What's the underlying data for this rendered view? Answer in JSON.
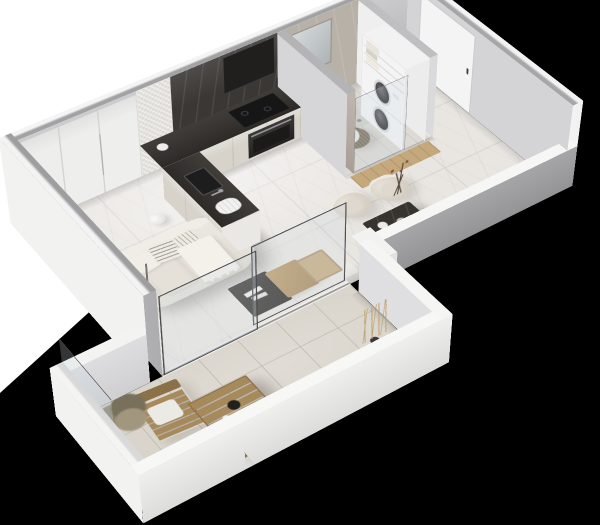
{
  "meta": {
    "description": "Photorealistic isometric 3D render of a small studio apartment floor plan, viewed from above at an angle, on a black void with a white backdrop filling the upper-left corner.",
    "width": 600,
    "height": 525
  },
  "palette": {
    "bg_black": "#000000",
    "backdrop_white": "#ffffff",
    "wall_far_face": "#c3c3c5",
    "wall_outer_white": "#f2f2f1",
    "floor_main": "#e9e6e2",
    "floor_line": "#d3cfca",
    "floor_bath": "#ddd9d4",
    "floor_balcony": "#d8d3ca",
    "balcony_line": "#bdb7ac",
    "wardrobe_panel": "#eeeeec",
    "wardrobe_seam": "#d2d2d0",
    "panel_textured": "#e4e2dd",
    "backsplash_dark": "#3a3734",
    "hood_black": "#201f1e",
    "counter_top": "#35322f",
    "cooktop_black": "#161616",
    "cabinet_front": "#d7d3cb",
    "cabinet_seam": "#c2beb5",
    "oven_dark": "#2b2a29",
    "sink_dark": "#1d1d1e",
    "steel": "#9fa3a6",
    "sofa_base": "#e7e4dd",
    "pillow": "#f1eee8",
    "pillow_stripe": "#8e887a",
    "throw": "#f4f1eb",
    "wood_coffee": "#b3925f",
    "wood_light": "#c9ad82",
    "marble_table": "#37332e",
    "chair_cream": "#d9d3c9",
    "rattan": "#867a63",
    "basin_white": "#f2f2f0",
    "towel": "#e9e4db",
    "towel2": "#d8d1c4",
    "washer_white": "#f4f4f4",
    "washer_door": "#2f2f33",
    "washer_ring": "#d9d9db",
    "door_white": "#f4f4f4",
    "door_frame": "#c9c9cb",
    "handle_dark": "#3e3e40",
    "glass_tint": "rgba(205,216,222,0.25)",
    "glass_frame": "#4d4d50",
    "wood_deck": "#c5a97c",
    "wood_furn": "#a78a5c",
    "wood_dark": "#8a7147",
    "plant_olive": "#8e8670",
    "plant_olive2": "#78705a",
    "plant_dry": "#c0a06a",
    "bath_marble": "#b8b1a8",
    "mirror_a": "#d6dadb",
    "mirror_b": "#aeb4b6",
    "shadow_soft": "rgba(90,85,78,0.4)",
    "shadow_faint": "rgba(90,85,78,0.18)"
  },
  "scene": {
    "type": "3d-floor-plan-render",
    "rooms": [
      {
        "name": "wardrobe-nook",
        "contents": [
          "white sliding-door wardrobe along the back wall"
        ]
      },
      {
        "name": "kitchen",
        "contents": [
          "L-shaped counter with dark marble top",
          "inset sink with faucet",
          "black cooktop",
          "oven below cooktop",
          "black range hood",
          "full-height dark marble backsplash",
          "stack of white plates",
          "textured tall pantry panel"
        ]
      },
      {
        "name": "bathroom",
        "contents": [
          "glass shower screen",
          "round white basin on rattan pedestal",
          "rattan stool with towel",
          "toilet",
          "wall mirror",
          "stacked washer and dryer column",
          "towel shelves",
          "wooden bath mat"
        ]
      },
      {
        "name": "entry-hall",
        "contents": [
          "white front door with dark handle"
        ]
      },
      {
        "name": "living-room",
        "contents": [
          "curved cream sofa with striped pillows and fringed throw",
          "wood and marble coffee table with books",
          "thin floor lamp",
          "square dark marble dining table with branch centerpiece and dishes",
          "two cream barrel chairs",
          "white floor vase",
          "pale area rug"
        ]
      },
      {
        "name": "balcony",
        "contents": [
          "two wooden slat chairs with white cushion",
          "wooden slat table with kettle and cups",
          "potted shrub",
          "dried grass plant in vase",
          "glass wind screen",
          "white parapet walls"
        ]
      }
    ],
    "background": {
      "upper_left": "white backdrop triangle",
      "remainder": "black void"
    }
  }
}
